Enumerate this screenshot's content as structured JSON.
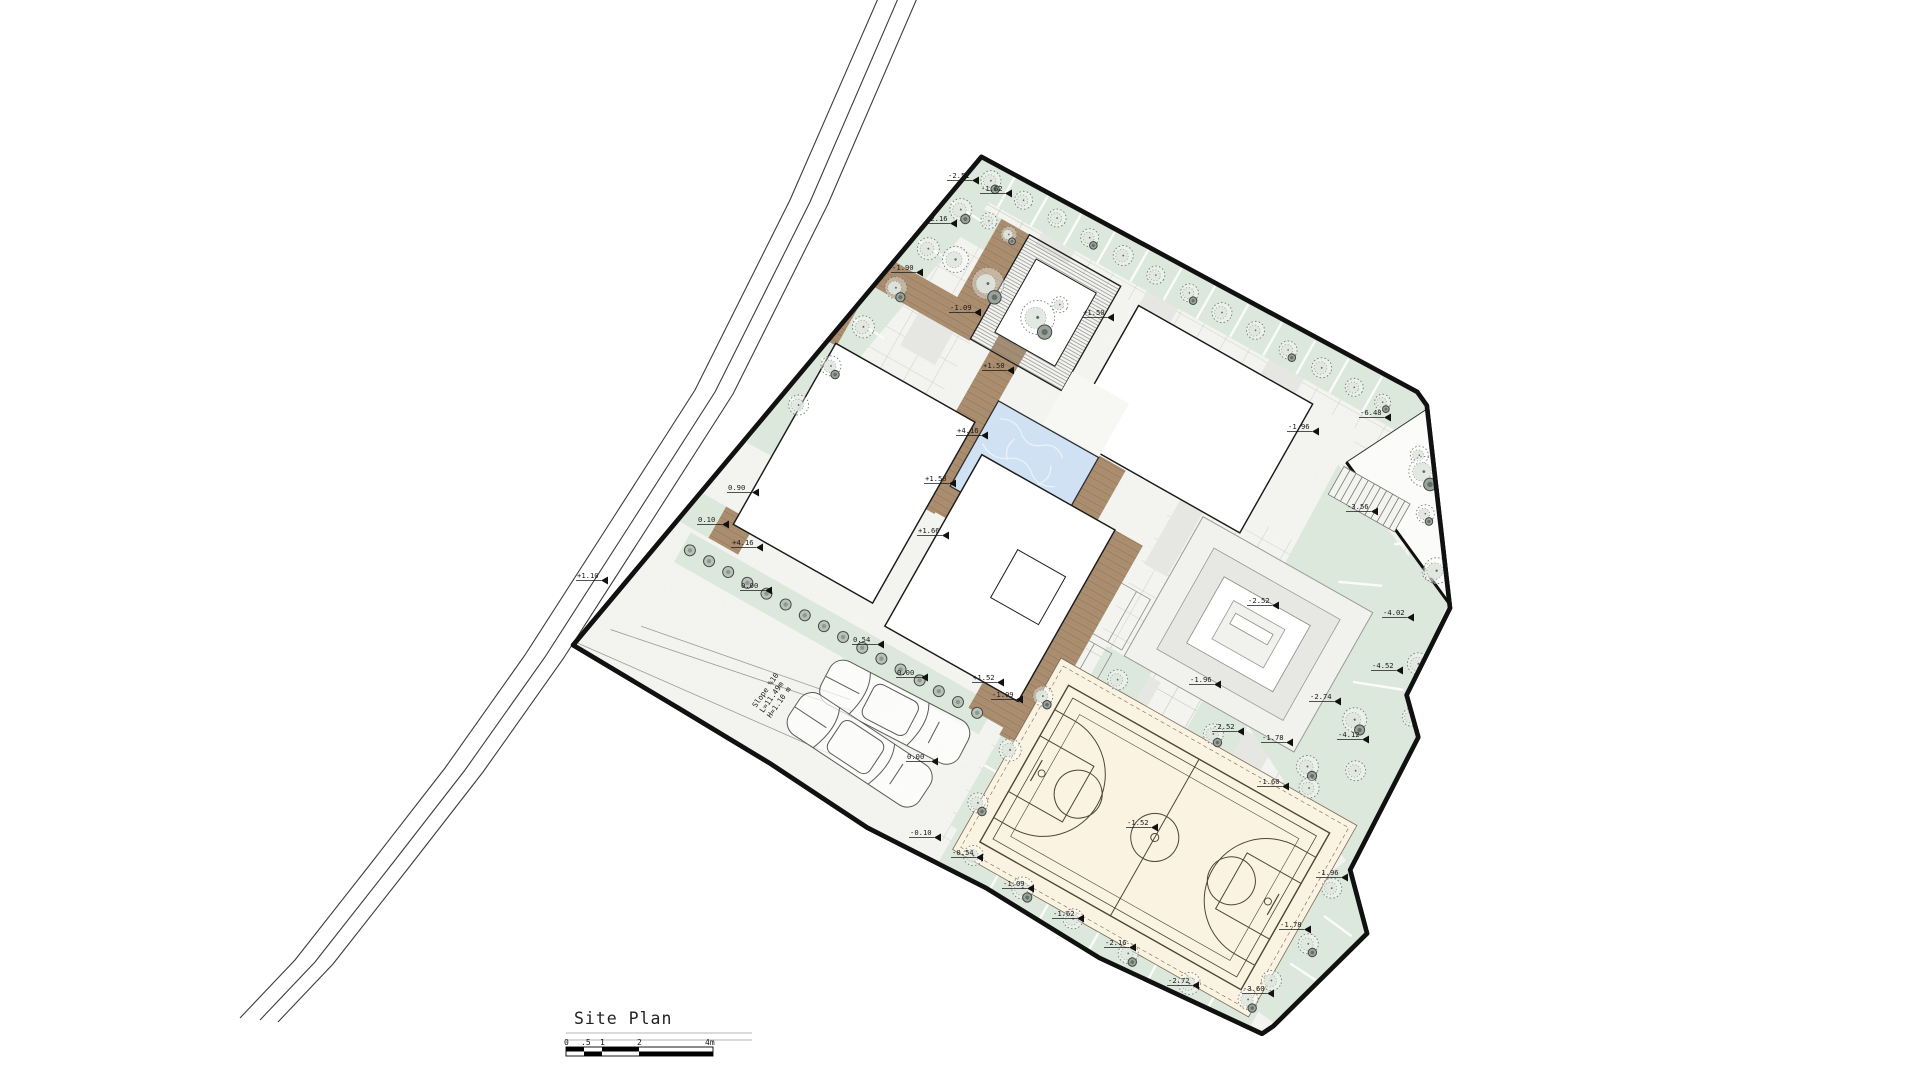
{
  "drawing": {
    "title": "Site Plan"
  },
  "scale_bar": {
    "ticks": [
      "0",
      ".5",
      "1",
      "2",
      "4m"
    ]
  },
  "slope_note": {
    "lines": [
      "Slope %10",
      "L=11.49m",
      "H=1.10 m"
    ]
  },
  "colors": {
    "boundary": "#111111",
    "planting_green": "#dce8dc",
    "deck_brown": "#ab8e70",
    "pool_blue": "#cfe1f3",
    "court_cream": "#faf3e2",
    "paper": "#f6f6f3"
  },
  "elevation_markers": [
    {
      "label": "+1.50",
      "x": 1103,
      "y": 317
    },
    {
      "label": "+1.50",
      "x": 1003,
      "y": 370
    },
    {
      "label": "+4.16",
      "x": 977,
      "y": 435
    },
    {
      "label": "+1.50",
      "x": 945,
      "y": 483
    },
    {
      "label": "+1.66",
      "x": 938,
      "y": 535
    },
    {
      "label": "0.90",
      "x": 748,
      "y": 492
    },
    {
      "label": "0.10",
      "x": 718,
      "y": 524
    },
    {
      "label": "+4.16",
      "x": 752,
      "y": 547
    },
    {
      "label": "0.00",
      "x": 761,
      "y": 590
    },
    {
      "label": "0.54",
      "x": 873,
      "y": 644
    },
    {
      "label": "0.00",
      "x": 917,
      "y": 677
    },
    {
      "label": "+1.52",
      "x": 993,
      "y": 682
    },
    {
      "label": "-1.09",
      "x": 1012,
      "y": 699
    },
    {
      "label": "0.00",
      "x": 927,
      "y": 761
    },
    {
      "label": "+1.10",
      "x": 597,
      "y": 580
    },
    {
      "label": "-2.51",
      "x": 968,
      "y": 180
    },
    {
      "label": "-1.62",
      "x": 1001,
      "y": 193
    },
    {
      "label": "-2.16",
      "x": 946,
      "y": 223
    },
    {
      "label": "-1.90",
      "x": 912,
      "y": 272
    },
    {
      "label": "-1.09",
      "x": 970,
      "y": 312
    },
    {
      "label": "-1.96",
      "x": 1210,
      "y": 684
    },
    {
      "label": "-2.52",
      "x": 1233,
      "y": 731
    },
    {
      "label": "-1.78",
      "x": 1282,
      "y": 742
    },
    {
      "label": "-1.60",
      "x": 1278,
      "y": 786
    },
    {
      "label": "-1.52",
      "x": 1147,
      "y": 827
    },
    {
      "label": "-0.10",
      "x": 930,
      "y": 837
    },
    {
      "label": "-0.54",
      "x": 972,
      "y": 857
    },
    {
      "label": "-1.09",
      "x": 1023,
      "y": 888
    },
    {
      "label": "-1.62",
      "x": 1073,
      "y": 918
    },
    {
      "label": "-2.16",
      "x": 1125,
      "y": 947
    },
    {
      "label": "-2.72",
      "x": 1188,
      "y": 985
    },
    {
      "label": "-3.60",
      "x": 1263,
      "y": 993
    },
    {
      "label": "-1.78",
      "x": 1300,
      "y": 929
    },
    {
      "label": "-1.96",
      "x": 1337,
      "y": 877
    },
    {
      "label": "-2.52",
      "x": 1268,
      "y": 605
    },
    {
      "label": "-1.96",
      "x": 1308,
      "y": 431
    },
    {
      "label": "-3.56",
      "x": 1367,
      "y": 511
    },
    {
      "label": "-6.48",
      "x": 1380,
      "y": 417
    },
    {
      "label": "-4.02",
      "x": 1403,
      "y": 617
    },
    {
      "label": "-4.52",
      "x": 1392,
      "y": 670
    },
    {
      "label": "-2.74",
      "x": 1330,
      "y": 701
    },
    {
      "label": "-4.12",
      "x": 1358,
      "y": 739
    }
  ]
}
